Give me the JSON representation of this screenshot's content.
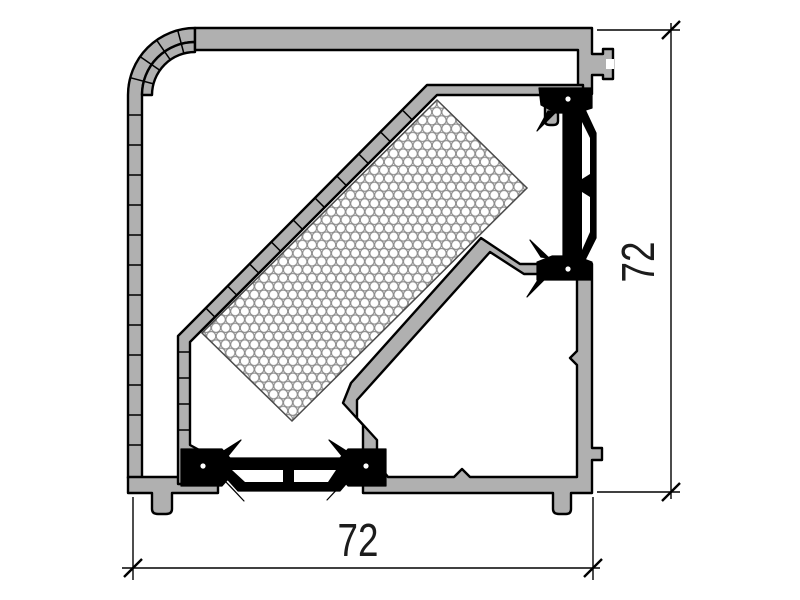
{
  "drawing": {
    "type": "technical-cross-section",
    "subject": "thermally-broken aluminum corner profile",
    "background_color": "#ffffff",
    "colors": {
      "aluminum_fill": "#b0b0b0",
      "outline": "#000000",
      "thermal_break_fill": "#000000",
      "insulation_hatch_stroke": "#8c8c8c"
    },
    "dimensions": {
      "width": {
        "label": "72",
        "orientation": "horizontal",
        "position": "bottom"
      },
      "height": {
        "label": "72",
        "orientation": "vertical",
        "position": "right"
      }
    },
    "parts": {
      "outer_cover": "rounded corner cover profile with segmented wall",
      "outer_shell": "top bar with side nub",
      "inner_profile": "diagonal insulated wall profile",
      "insulation_block": "honeycomb-hatched insulation strip at 45 degrees",
      "thermal_breaks": [
        "right vertical polyamide strut",
        "bottom horizontal polyamide strut"
      ],
      "main_chamber": "pentagonal hollow chamber"
    }
  }
}
